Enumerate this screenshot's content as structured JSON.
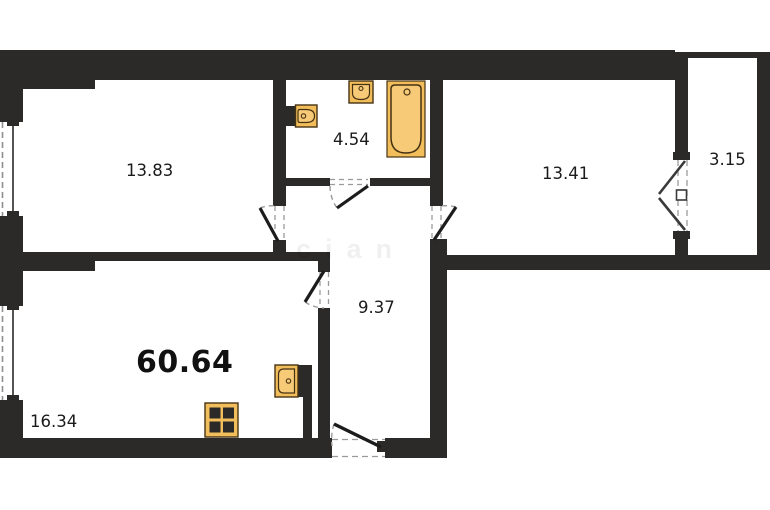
{
  "plan": {
    "total_area": "60.64",
    "watermark": "cian",
    "rooms": [
      {
        "name": "living-room",
        "area": "13.83"
      },
      {
        "name": "bathroom",
        "area": "4.54"
      },
      {
        "name": "bedroom",
        "area": "13.41"
      },
      {
        "name": "balcony",
        "area": "3.15"
      },
      {
        "name": "hallway",
        "area": "9.37"
      },
      {
        "name": "kitchen-living",
        "area": "16.34"
      }
    ],
    "fixtures": [
      "toilet",
      "wall-sink",
      "bathtub",
      "kitchen-sink",
      "stove"
    ],
    "colors": {
      "wall": "#2b2a28",
      "fixture_fill": "#f2bd5b",
      "fixture_fill_light": "#f6ca77",
      "fixture_stroke": "#463213",
      "dash": "#8f8f8f",
      "door_leaf": "#1c1c1c",
      "text": "#1b1b1b"
    }
  }
}
